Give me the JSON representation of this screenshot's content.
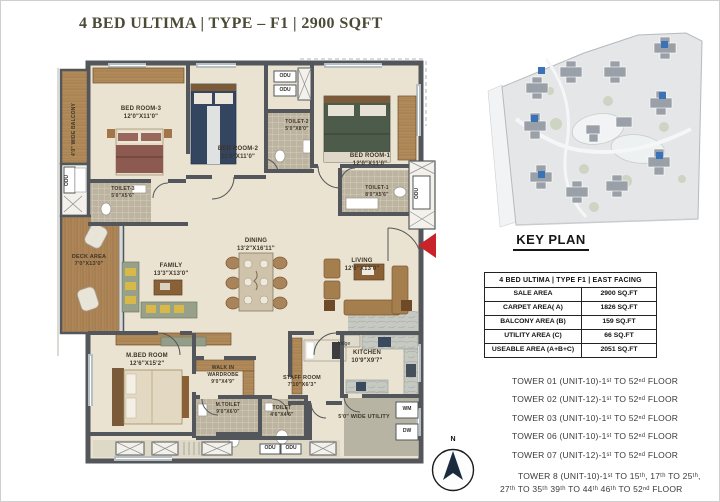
{
  "title": "4 BED ULTIMA | TYPE – F1 | 2900 SQFT",
  "floor_plan": {
    "rooms": [
      {
        "name": "BED ROOM-3",
        "dims": "12'0\"X11'0\""
      },
      {
        "name": "BED ROOM-2",
        "dims": "11'0\"X11'0\""
      },
      {
        "name": "BED ROOM-1",
        "dims": "12'0\"X11'0\""
      },
      {
        "name": "TOILET-3",
        "dims": "5'0\"X5'6\""
      },
      {
        "name": "TOILET-2",
        "dims": "5'0\"X8'0\""
      },
      {
        "name": "TOILET-1",
        "dims": "8'0\"X5'6\""
      },
      {
        "name": "DECK AREA",
        "dims": "7'0\"X13'0\""
      },
      {
        "name": "FAMILY",
        "dims": "13'3\"X13'0\""
      },
      {
        "name": "DINING",
        "dims": "13'2\"X16'11\""
      },
      {
        "name": "LIVING",
        "dims": "12'6\"X13'0\""
      },
      {
        "name": "M.BED ROOM",
        "dims": "12'6\"X15'2\""
      },
      {
        "name": "WALK IN WARDROBE",
        "dims": "9'0\"X4'9\""
      },
      {
        "name": "M.TOILET",
        "dims": "9'0\"X6'0\""
      },
      {
        "name": "TOILET",
        "dims": "4'6\"X4'6\""
      },
      {
        "name": "STAFF ROOM",
        "dims": "7'10\"X6'3\""
      },
      {
        "name": "KITCHEN",
        "dims": "10'9\"X9'7\""
      }
    ],
    "balcony_label": "4'0\" WIDE BALCONY",
    "utility_label": "5'0\" WIDE UTILITY",
    "odu": "ODU",
    "wm": "WM",
    "dw": "DW",
    "fridge": "fridge"
  },
  "key_plan": {
    "heading": "KEY PLAN",
    "table": {
      "header": "4 BED ULTIMA | TYPE F1 | EAST FACING",
      "rows": [
        {
          "label": "SALE AREA",
          "value": "2900 SQ.FT"
        },
        {
          "label": "CARPET AREA( A)",
          "value": "1826 SQ.FT"
        },
        {
          "label": "BALCONY AREA (B)",
          "value": "159 SQ.FT"
        },
        {
          "label": "UTILITY AREA (C)",
          "value": "66 SQ.FT"
        },
        {
          "label": "USEABLE AREA (A+B+C)",
          "value": "2051 SQ.FT"
        }
      ]
    }
  },
  "towers": [
    "TOWER 01 (UNIT-10)-1ˢᵗ TO 52ⁿᵈ FLOOR",
    "TOWER 02 (UNIT-12)-1ˢᵗ TO 52ⁿᵈ FLOOR",
    "TOWER 03 (UNIT-10)-1ˢᵗ TO 52ⁿᵈ FLOOR",
    "TOWER 06 (UNIT-10)-1ˢᵗ TO 52ⁿᵈ FLOOR",
    "TOWER 07 (UNIT-12)-1ˢᵗ TO 52ⁿᵈ FLOOR",
    "TOWER 8 (UNIT-10)-1ˢᵗ TO 15ᵗʰ, 17ᵗʰ TO 25ᵗʰ,",
    "27ᵗʰ TO 35ᵗʰ 39ᵗʰ TO 44ᵗʰ 46ᵗʰ TO 52ⁿᵈ FLOOR"
  ],
  "compass": {
    "north": "N"
  }
}
